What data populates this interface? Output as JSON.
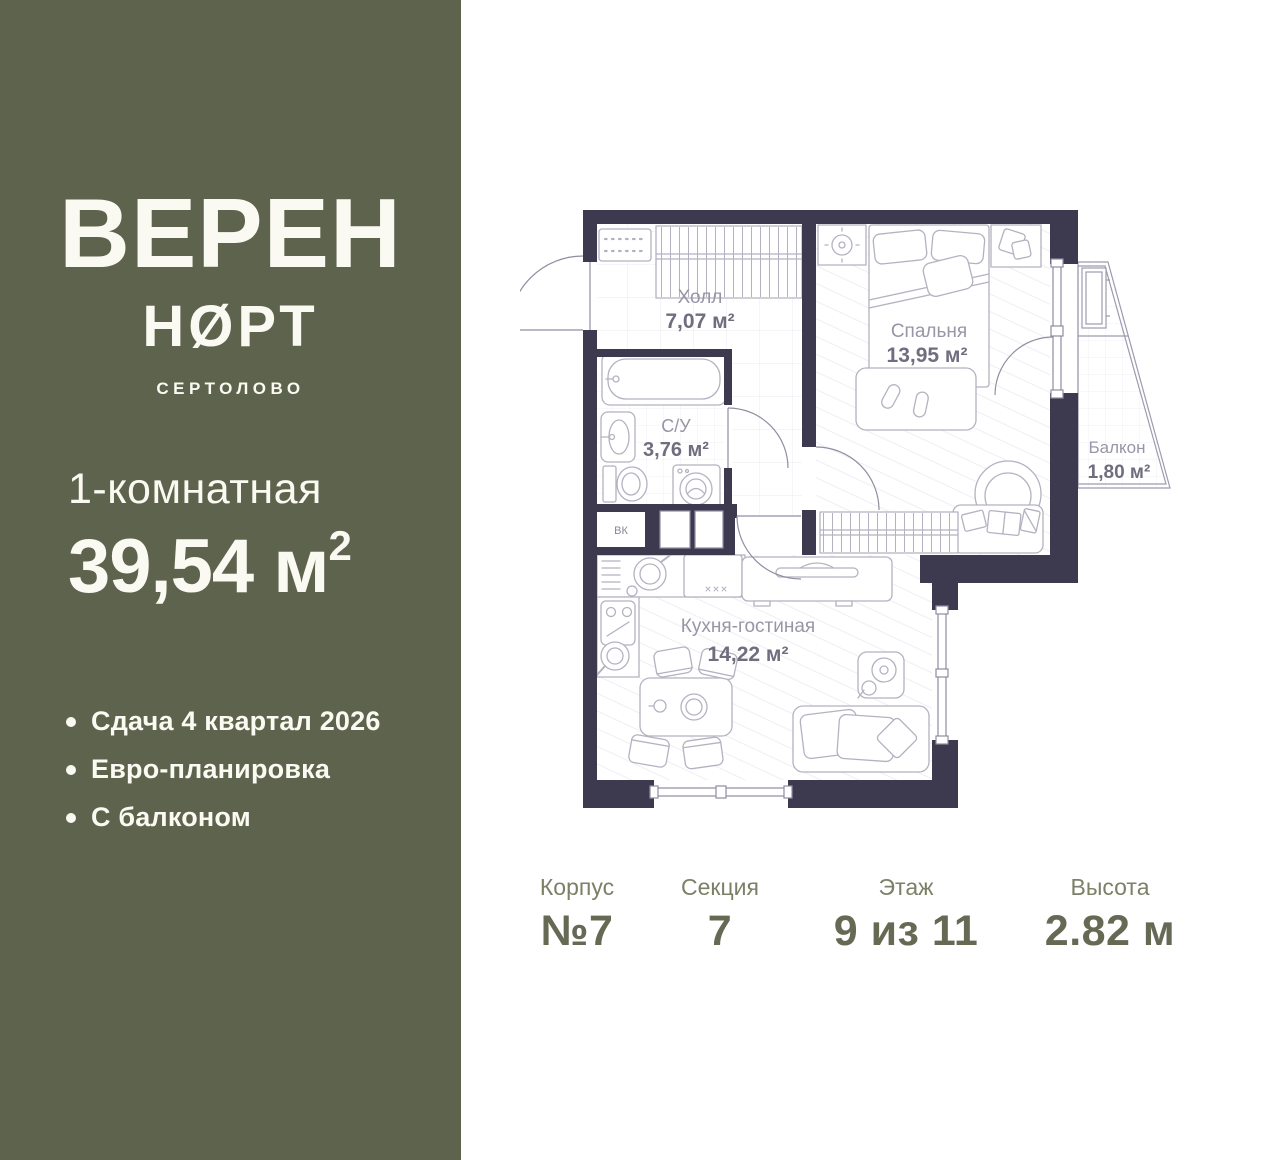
{
  "sidebar": {
    "brand_line1": "ВЕРЕН",
    "brand_line2": "НØРТ",
    "location": "СЕРТОЛОВО",
    "unit_type": "1-комнатная",
    "area_value": "39,54 м",
    "area_superscript": "2",
    "features": [
      {
        "label": "Сдача 4 квартал 2026"
      },
      {
        "label": "Евро-планировка"
      },
      {
        "label": "С балконом"
      }
    ],
    "colors": {
      "background": "#5e634e",
      "text": "#fbfaf2"
    }
  },
  "plan": {
    "rooms": {
      "hall": {
        "name": "Холл",
        "area": "7,07 м²"
      },
      "bathroom": {
        "name": "С/У",
        "area": "3,76 м²"
      },
      "closet": {
        "name": "ВК"
      },
      "bedroom": {
        "name": "Спальня",
        "area": "13,95 м²"
      },
      "kitchen": {
        "name": "Кухня-гостиная",
        "area": "14,22 м²"
      },
      "balcony": {
        "name": "Балкон",
        "area": "1,80 м²"
      }
    },
    "colors": {
      "walls": "#3d3a50",
      "furniture": "#b4b2c1",
      "room_name": "#9896a6",
      "room_area": "#6f6d7e"
    }
  },
  "stats": [
    {
      "label": "Корпус",
      "value": "№7"
    },
    {
      "label": "Секция",
      "value": "7"
    },
    {
      "label": "Этаж",
      "value": "9 из 11"
    },
    {
      "label": "Высота",
      "value": "2.82 м"
    }
  ]
}
